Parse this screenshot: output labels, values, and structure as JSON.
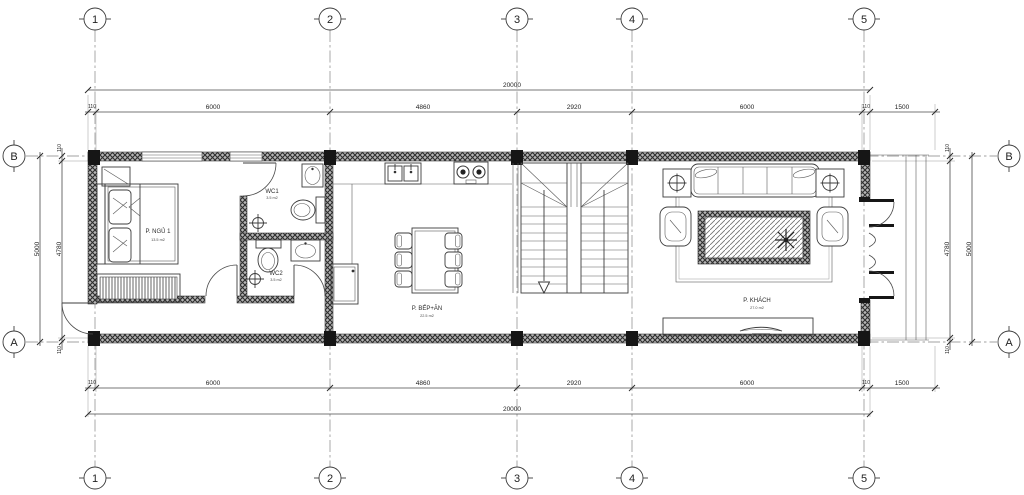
{
  "grid": {
    "cols": [
      "1",
      "2",
      "3",
      "4",
      "5"
    ],
    "rows": [
      "B",
      "A"
    ]
  },
  "dims": {
    "total": "20000",
    "segments": [
      "110",
      "6000",
      "4860",
      "2920",
      "6000",
      "110",
      "1500"
    ],
    "side_total": "5000",
    "side_inner": "4780",
    "side_edge_top": "110",
    "side_edge_bottom": "110"
  },
  "rooms": {
    "bedroom": {
      "name": "P. NGỦ 1",
      "area": "13.5 m2"
    },
    "wc1": {
      "name": "WC1",
      "area": "3.5 m2"
    },
    "wc2": {
      "name": "WC2",
      "area": "3.5 m2"
    },
    "kitchen": {
      "name": "P. BẾP+ĂN",
      "area": "22.5 m2"
    },
    "living": {
      "name": "P. KHÁCH",
      "area": "27.0 m2"
    }
  }
}
